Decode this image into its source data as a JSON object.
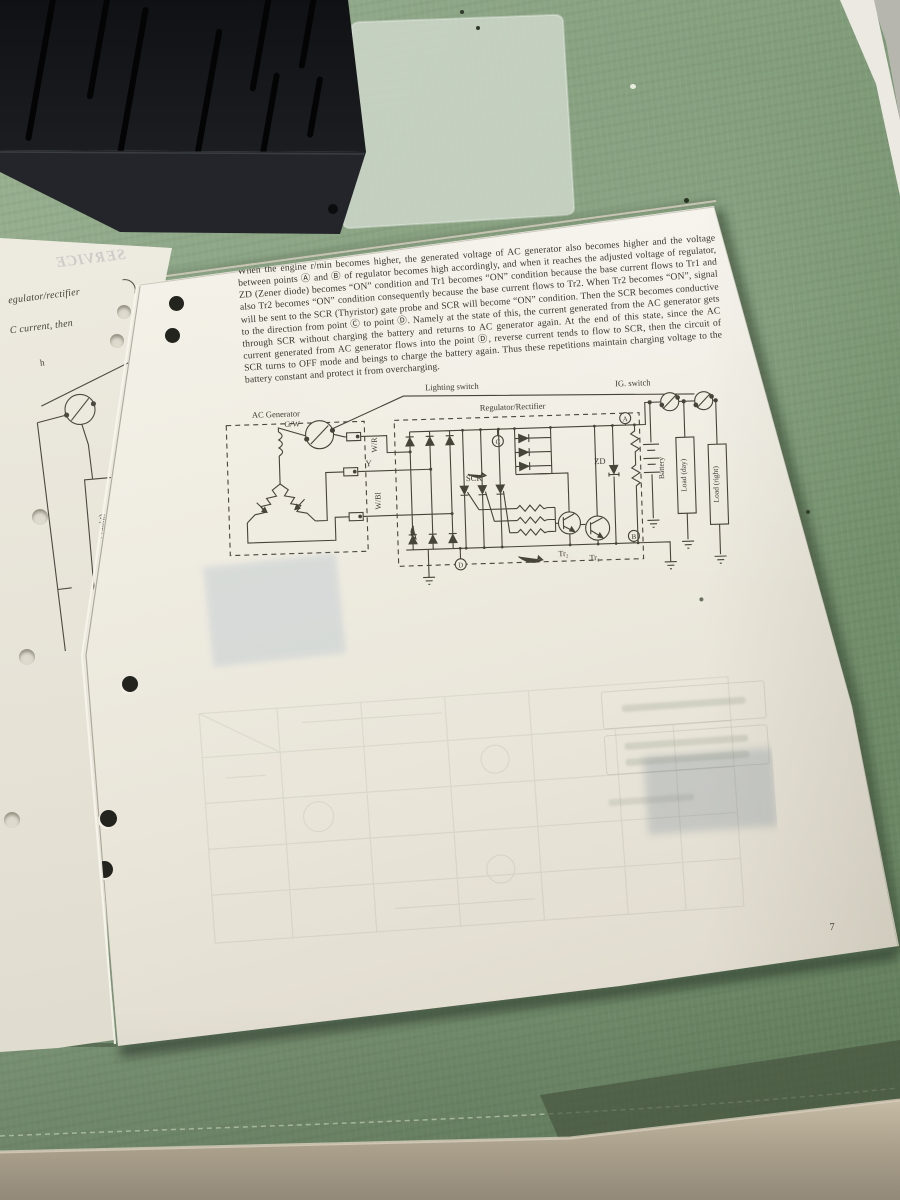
{
  "page": {
    "paragraph": "When the engine r/min becomes higher, the generated voltage of AC generator also becomes higher and the voltage between points Ⓐ and Ⓑ of regulator becomes high accordingly, and when it reaches the adjusted voltage of regulator, ZD (Zener diode) becomes “ON” condition and Tr1 becomes “ON” condition because the base current flows to Tr1 and also Tr2 becomes “ON” condition consequently because the base current flows to Tr2.  When Tr2 becomes “ON”, signal will be sent to the SCR (Thyristor) gate probe and SCR will become “ON” condition. Then the SCR becomes conductive to the direction from point Ⓒ to point Ⓓ.  Namely at the state of this, the current generated from the AC generator gets through SCR without charging the battery and returns to AC generator again.  At the end of this state, since the AC current generated from AC generator flows into the point Ⓓ, reverse current tends to flow to SCR, then the circuit of SCR turns to OFF mode and beings to charge the battery again.  Thus these repetitions maintain charging voltage to the battery constant and protect it from overcharging.",
    "page_number": "7"
  },
  "diagram": {
    "lighting_switch": "Lighting switch",
    "regulator_rectifier": "Regulator/Rectifier",
    "ac_generator": "AC Generator",
    "ig_switch": "IG. switch",
    "wire_gw": "G/W",
    "wire_wr": "W/R",
    "wire_y": "Y",
    "wire_wbl": "W/Bl",
    "scr": "SCR",
    "zd": "ZD",
    "tr2": "Tr₂",
    "tr1": "Tr₁",
    "battery": "Battery",
    "load_day": "Load (day)",
    "load_right": "Load (right)",
    "point_a": "A",
    "point_b": "B",
    "point_c": "C",
    "point_d": "D"
  },
  "left_page": {
    "ghost_header": "SERVICE",
    "line1": "egulator/rectifier",
    "line2": "C current, then",
    "fragment": "h",
    "load_right": "Load (right)"
  },
  "colors": {
    "fabric_green": "#87a17d",
    "paper_white": "#f2efe6",
    "ink": "#3e3a32"
  }
}
